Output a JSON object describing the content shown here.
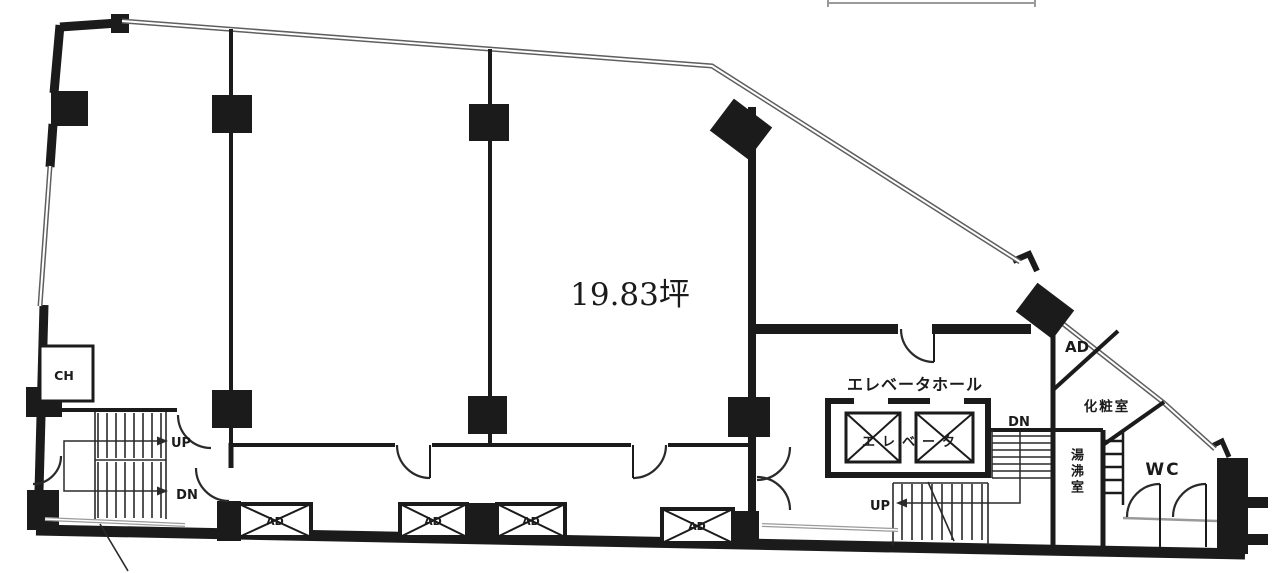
{
  "plan": {
    "area_label": "19.83坪",
    "rooms": {
      "elevator_hall_label": "エレベータホール",
      "elevator_label": "エレベータ",
      "powder_room_label": "化粧室",
      "kitchenette_label": "湯沸室",
      "wc_label": "WC",
      "ch_label": "CH",
      "ad_label": "AD"
    },
    "stairs": {
      "left_up": "UP",
      "left_dn": "DN",
      "right_up": "UP",
      "right_dn": "DN"
    },
    "vents": {
      "labels": [
        "AD",
        "AD",
        "AD",
        "AD"
      ]
    },
    "colors": {
      "line": "#1b1b1b",
      "double_line": "#5f5f5f",
      "background": "#ffffff"
    }
  }
}
